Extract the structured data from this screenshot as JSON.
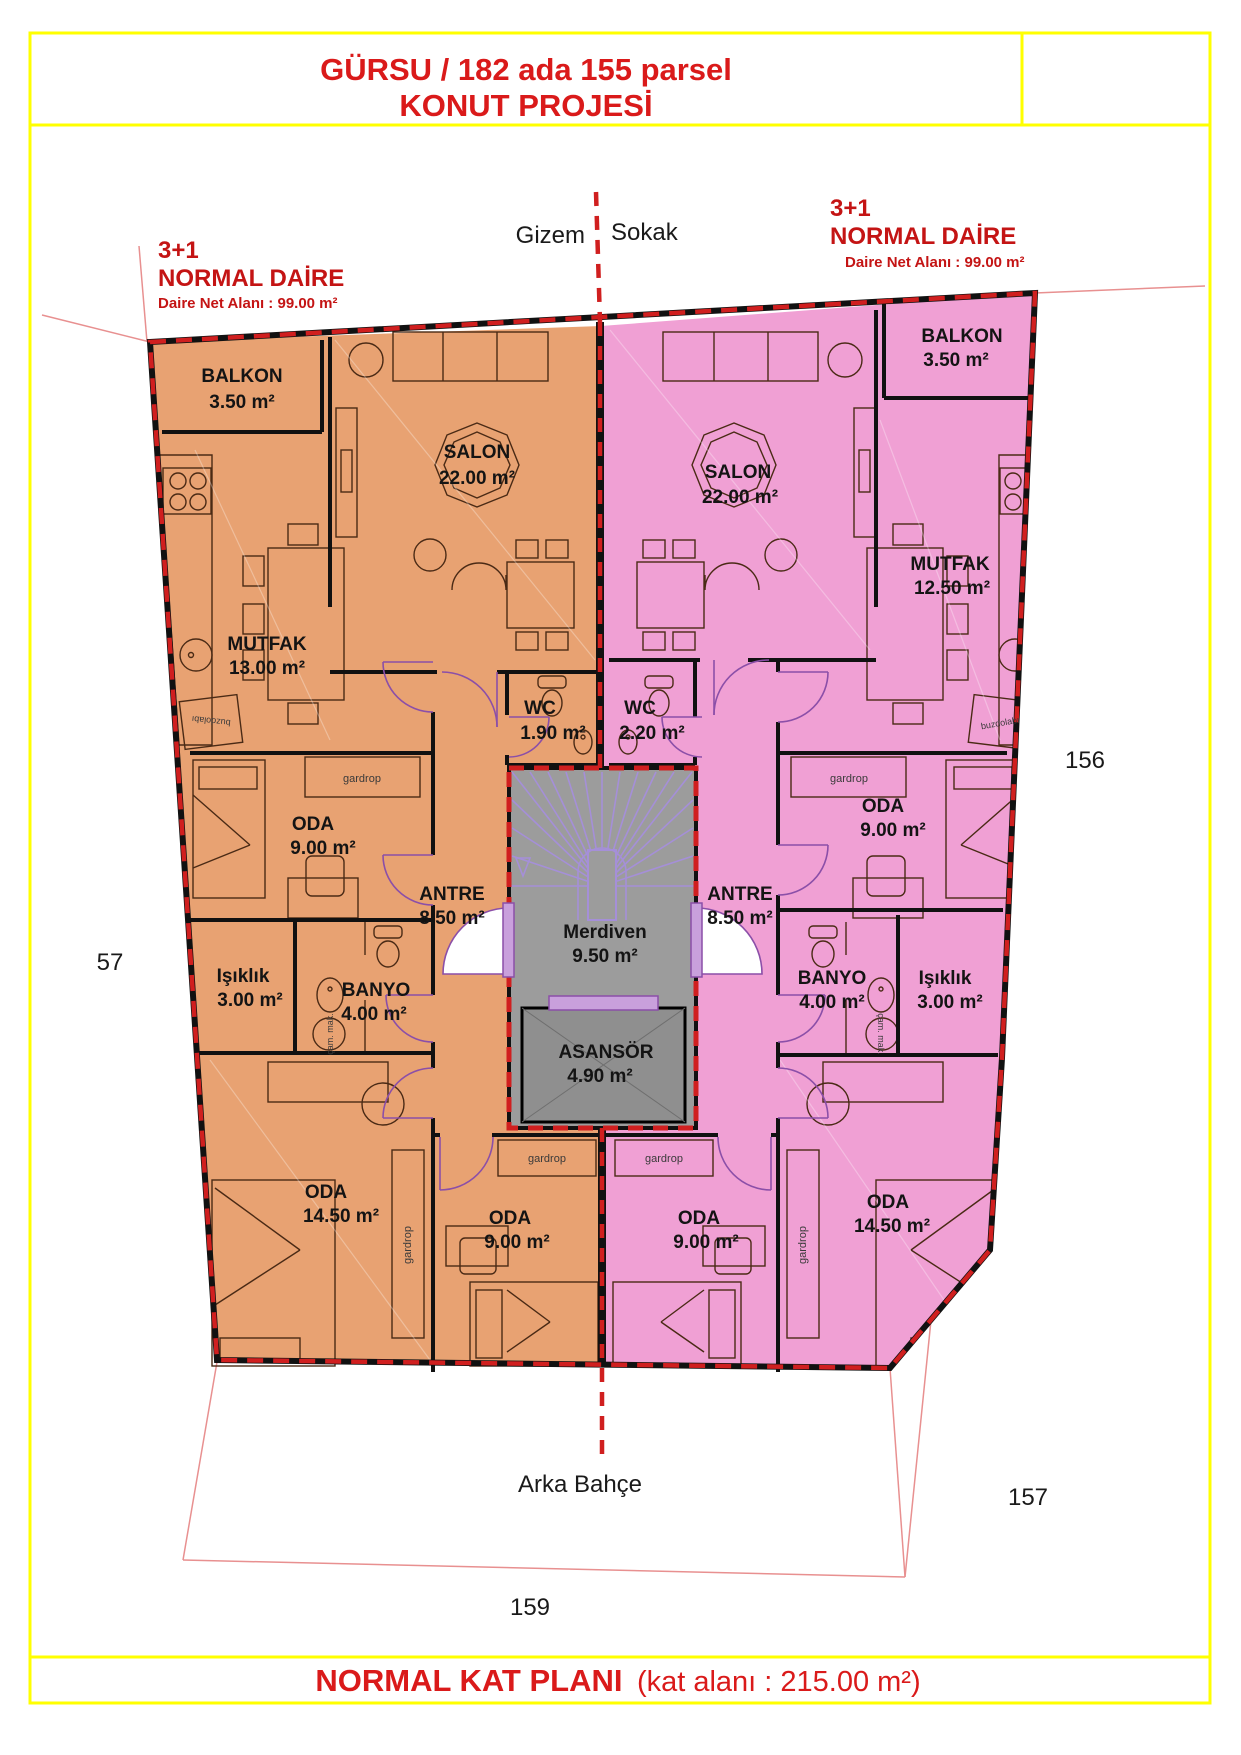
{
  "title": {
    "line1": "GÜRSU / 182 ada 155 parsel",
    "line2": "KONUT PROJESİ"
  },
  "street": {
    "word1": "Gizem",
    "word2": "Sokak"
  },
  "garden": {
    "label": "Arka Bahçe"
  },
  "apartments": {
    "left": {
      "type": "3+1",
      "name": "NORMAL DAİRE",
      "net": "Daire Net Alanı : 99.00 m²"
    },
    "right": {
      "type": "3+1",
      "name": "NORMAL DAİRE",
      "net": "Daire Net Alanı : 99.00 m²"
    }
  },
  "rooms": {
    "left": {
      "balkon": {
        "n": "BALKON",
        "a": "3.50 m²"
      },
      "salon": {
        "n": "SALON",
        "a": "22.00 m²"
      },
      "mutfak": {
        "n": "MUTFAK",
        "a": "13.00 m²"
      },
      "wc": {
        "n": "WC",
        "a": "1.90 m²"
      },
      "oda1": {
        "n": "ODA",
        "a": "9.00 m²"
      },
      "antre": {
        "n": "ANTRE",
        "a": "8.50 m²"
      },
      "isiklik": {
        "n": "Işıklık",
        "a": "3.00 m²"
      },
      "banyo": {
        "n": "BANYO",
        "a": "4.00 m²"
      },
      "oda2": {
        "n": "ODA",
        "a": "14.50 m²"
      },
      "oda3": {
        "n": "ODA",
        "a": "9.00 m²"
      }
    },
    "right": {
      "balkon": {
        "n": "BALKON",
        "a": "3.50 m²"
      },
      "salon": {
        "n": "SALON",
        "a": "22.00 m²"
      },
      "mutfak": {
        "n": "MUTFAK",
        "a": "12.50 m²"
      },
      "wc": {
        "n": "WC",
        "a": "2.20 m²"
      },
      "oda1": {
        "n": "ODA",
        "a": "9.00 m²"
      },
      "antre": {
        "n": "ANTRE",
        "a": "8.50 m²"
      },
      "banyo": {
        "n": "BANYO",
        "a": "4.00 m²"
      },
      "isiklik": {
        "n": "Işıklık",
        "a": "3.00 m²"
      },
      "oda2": {
        "n": "ODA",
        "a": "14.50 m²"
      },
      "oda3": {
        "n": "ODA",
        "a": "9.00 m²"
      }
    },
    "common": {
      "merdiven": {
        "n": "Merdiven",
        "a": "9.50 m²"
      },
      "asansor": {
        "n": "ASANSÖR",
        "a": "4.90 m²"
      }
    }
  },
  "fixtures": {
    "gardrop": "gardrop",
    "buzdolabi": "buzdolabı",
    "cam_mak": "çam. mak."
  },
  "dimensions": {
    "left": "57",
    "right": "156",
    "bottom_right": "157",
    "bottom": "159"
  },
  "footer": {
    "title": "NORMAL KAT PLANI",
    "area": "(kat alanı : 215.00 m²)"
  },
  "colors": {
    "accent_red": "#DA1A1A",
    "boundary_red": "#D01F1F",
    "frame_yellow": "#FFFF00",
    "left_fill": "#E8A272",
    "right_fill": "#F0A0D4",
    "stair_fill": "#9C9C9C",
    "door_purple": "#8B4FA8"
  }
}
